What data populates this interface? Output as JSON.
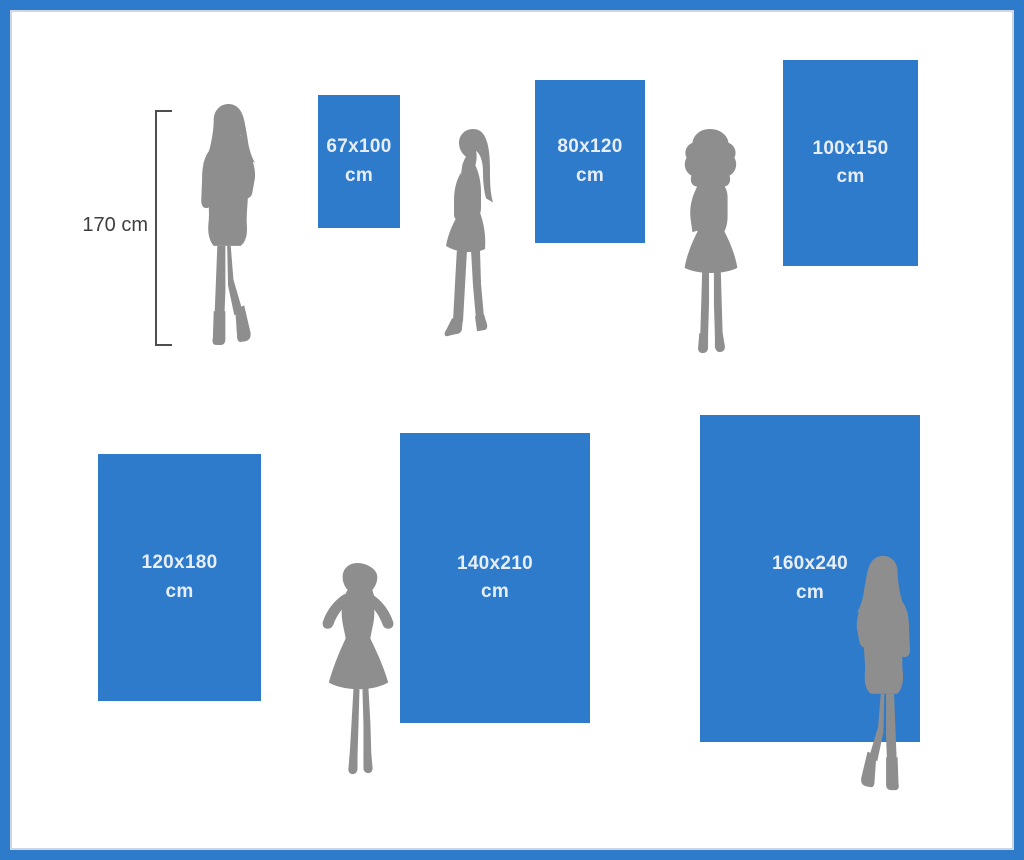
{
  "colors": {
    "blue": "#2e7bcb",
    "silhouette": "#8e8e8e",
    "label_text": "#e7eef8",
    "measure_text": "#3e3e3e"
  },
  "measure": {
    "height_label": "170 cm"
  },
  "sizes": [
    {
      "label": "67x100",
      "unit": "cm"
    },
    {
      "label": "80x120",
      "unit": "cm"
    },
    {
      "label": "100x150",
      "unit": "cm"
    },
    {
      "label": "120x180",
      "unit": "cm"
    },
    {
      "label": "140x210",
      "unit": "cm"
    },
    {
      "label": "160x240",
      "unit": "cm"
    }
  ]
}
